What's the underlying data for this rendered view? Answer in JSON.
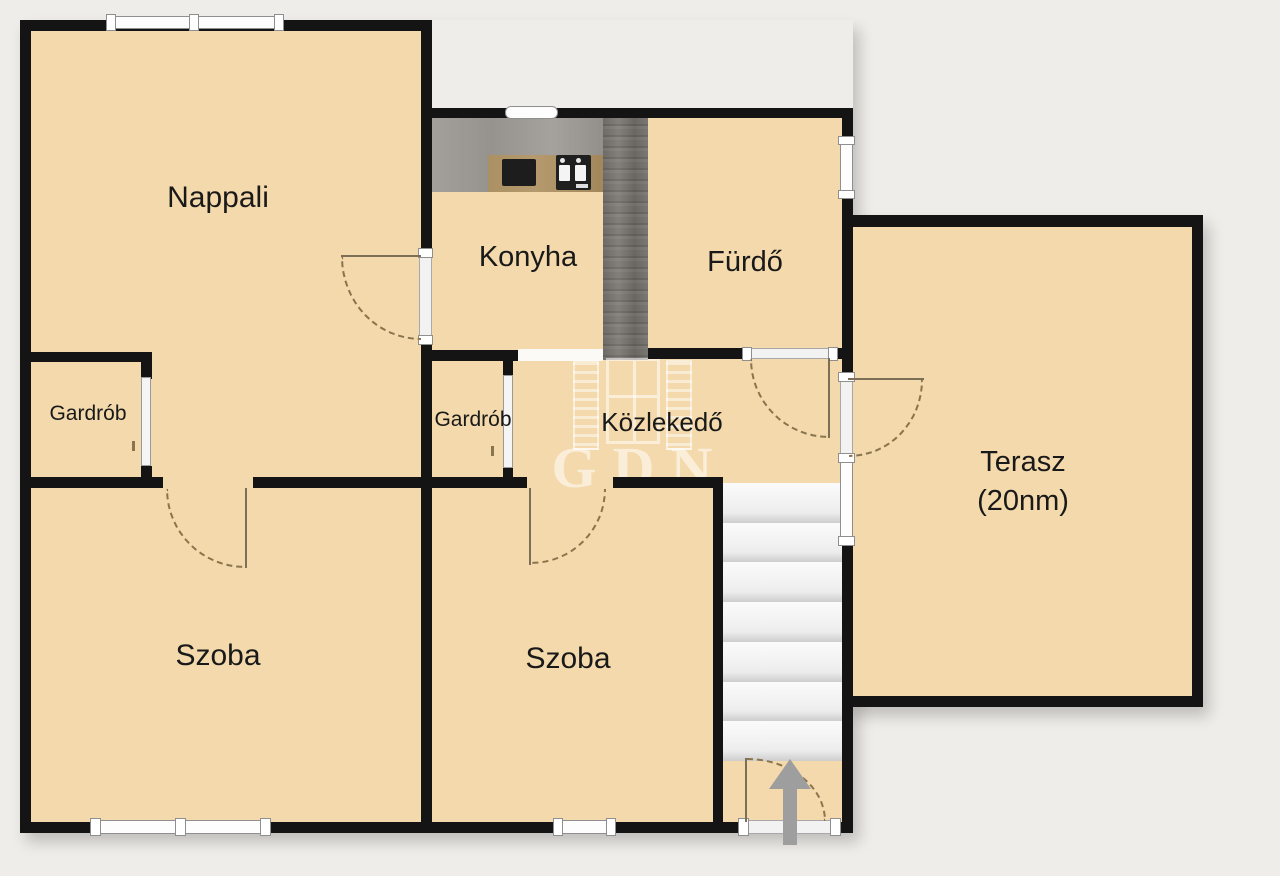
{
  "plan": {
    "type": "floor-plan",
    "watermark": "GDN",
    "rooms": [
      {
        "id": "nappali",
        "label": "Nappali"
      },
      {
        "id": "konyha",
        "label": "Konyha"
      },
      {
        "id": "furdo",
        "label": "Fürdő"
      },
      {
        "id": "gardrob-1",
        "label": "Gardrób"
      },
      {
        "id": "gardrob-2",
        "label": "Gardrób"
      },
      {
        "id": "kozlekedo",
        "label": "Közlekedő"
      },
      {
        "id": "terasz",
        "label": "Terasz",
        "sublabel": "(20nm)"
      },
      {
        "id": "szoba-1",
        "label": "Szoba"
      },
      {
        "id": "szoba-2",
        "label": "Szoba"
      }
    ],
    "features": {
      "stairs_steps": 7,
      "entrance_arrow_direction": "up"
    },
    "colors": {
      "background": "#efede9",
      "floor": "#f3d9ab",
      "wall": "#141414",
      "stair_tread": "#f0f0f0",
      "arrow": "#9e9e9e",
      "counter": "#9d9995",
      "wood_divider": "#736f6a",
      "counter_wood": "#ab9064"
    }
  }
}
